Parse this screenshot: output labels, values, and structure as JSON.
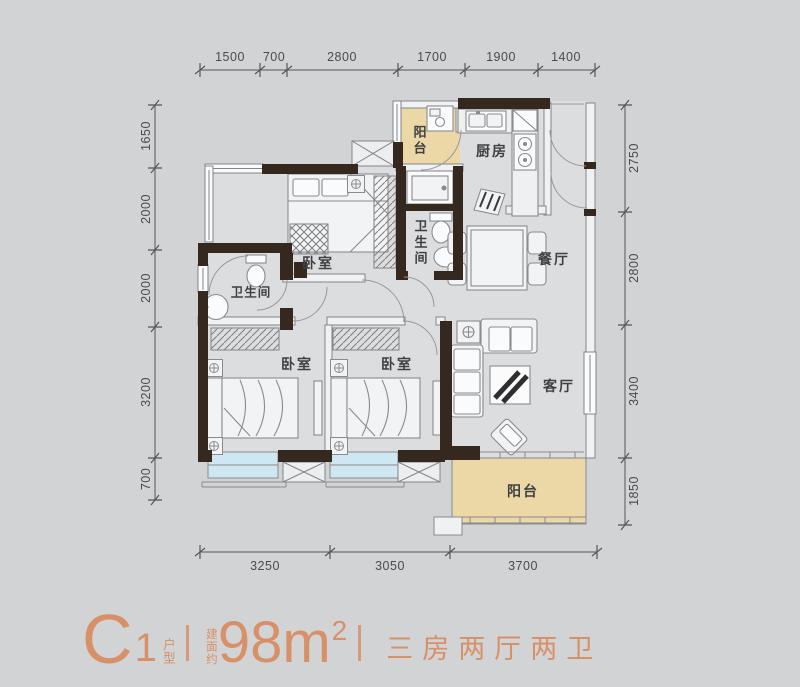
{
  "colors": {
    "background": "#d2d3d5",
    "floor": "#dcddde",
    "wall_dark": "#35291f",
    "balcony_fill": "#ecd7a6",
    "bay_window_fill": "#cfe7f2",
    "accent": "#d79067",
    "line": "#85868a",
    "text": "#3f4044"
  },
  "plan": {
    "rooms": [
      {
        "id": "balcony-top",
        "label": "阳台",
        "orientation": "vertical"
      },
      {
        "id": "kitchen",
        "label": "厨房",
        "orientation": "horizontal"
      },
      {
        "id": "bathroom-middle",
        "label": "卫生间",
        "orientation": "vertical"
      },
      {
        "id": "dining-room",
        "label": "餐厅",
        "orientation": "horizontal"
      },
      {
        "id": "bedroom-top",
        "label": "卧室",
        "orientation": "horizontal"
      },
      {
        "id": "bathroom-left",
        "label": "卫生间",
        "orientation": "horizontal"
      },
      {
        "id": "bedroom-bottom-left",
        "label": "卧室",
        "orientation": "horizontal"
      },
      {
        "id": "bedroom-bottom-middle",
        "label": "卧室",
        "orientation": "horizontal"
      },
      {
        "id": "living-room",
        "label": "客厅",
        "orientation": "horizontal"
      },
      {
        "id": "balcony-bottom",
        "label": "阳台",
        "orientation": "horizontal"
      }
    ],
    "dimensions": {
      "top": [
        "1500",
        "700",
        "2800",
        "1700",
        "1900",
        "1400"
      ],
      "left": [
        "1650",
        "2000",
        "2000",
        "3200",
        "700"
      ],
      "right": [
        "2750",
        "2800",
        "3400",
        "1850"
      ],
      "bottom": [
        "3250",
        "3050",
        "3700"
      ]
    }
  },
  "footer": {
    "model_letter": "C",
    "model_number": "1",
    "model_suffix": "户型",
    "area_prefix": "建面约",
    "area_value": "98m",
    "area_superscript": "2",
    "tagline": "三房两厅两卫"
  }
}
